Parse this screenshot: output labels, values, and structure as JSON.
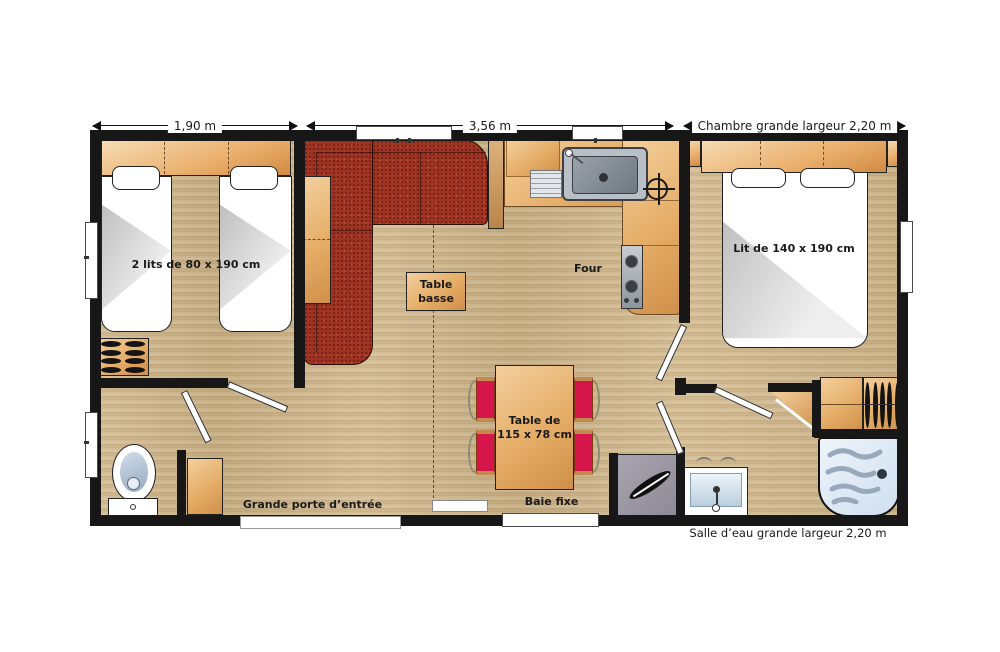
{
  "dimensions": {
    "left_room_width": "1,90 m",
    "living_width": "3,56 m",
    "right_room_width": "Chambre grande largeur 2,20 m"
  },
  "labels": {
    "twin_beds": "2 lits de 80 x 190 cm",
    "double_bed": "Lit de 140 x 190 cm",
    "coffee_table_line1": "Table",
    "coffee_table_line2": "basse",
    "oven": "Four",
    "dining_table_line1": "Table de",
    "dining_table_line2": "115 x 78 cm",
    "entrance_door": "Grande porte d’entrée",
    "fixed_bay_window": "Baie fixe",
    "shower_room": "Salle d’eau grande largeur 2,20 m"
  },
  "icons": {
    "sink": "kitchen-sink-icon",
    "cooktop": "cooktop-icon",
    "gas_valve": "crosshair-valve-icon",
    "toilet": "toilet-icon",
    "washbasin": "washbasin-icon",
    "shower": "shower-tray-icon",
    "hangers": "wardrobe-hangers-icon"
  },
  "colors": {
    "wall": "#171717",
    "floor_wood": "#cdb184",
    "furniture_tan": "#e5ad67",
    "sofa_red": "#a33322",
    "chair_red": "#d6164a",
    "steel_grey": "#aab2b8",
    "shower_blue": "#dfeaf4"
  }
}
